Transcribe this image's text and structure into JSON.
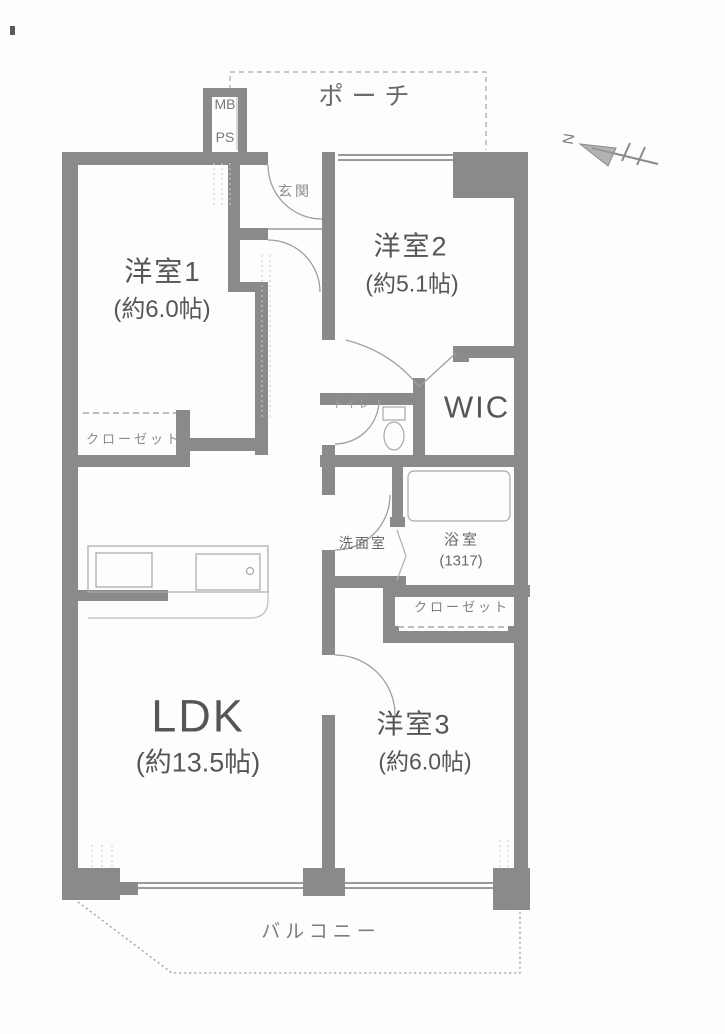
{
  "compass": {
    "n": "N"
  },
  "labels": {
    "porch": "ポーチ",
    "mb": "MB",
    "ps": "PS",
    "entrance": "玄関",
    "room1": "洋室1",
    "room1_size": "(約6.0帖)",
    "room2": "洋室2",
    "room2_size": "(約5.1帖)",
    "wic": "WIC",
    "toilet": "トイレ",
    "closet_left": "クローゼット",
    "washroom": "洗面室",
    "bath": "浴室",
    "bath_size": "(1317)",
    "closet_right": "クローゼット",
    "ldk": "LDK",
    "ldk_size": "(約13.5帖)",
    "room3": "洋室3",
    "room3_size": "(約6.0帖)",
    "balcony": "バルコニー"
  }
}
